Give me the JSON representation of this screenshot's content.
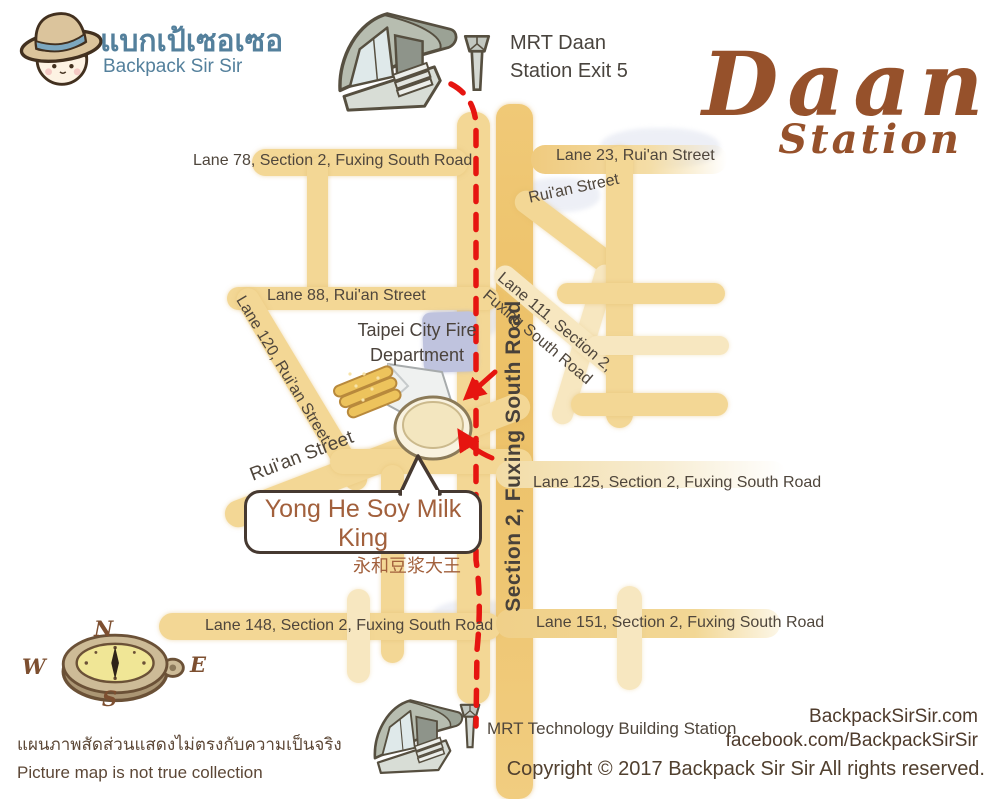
{
  "brand": {
    "name_thai": "แบกเป้เซอเซอ",
    "name_en": "Backpack Sir Sir"
  },
  "title": {
    "main": "Daan",
    "sub": "Station"
  },
  "stations": {
    "daan_line1": "MRT Daan",
    "daan_line2": "Station Exit 5",
    "technology": "MRT Technology Building Station"
  },
  "destination": {
    "name_en": "Yong He Soy Milk King",
    "name_zh": "永和豆浆大王"
  },
  "landmarks": {
    "fire_line1": "Taipei City Fire",
    "fire_line2": "Department"
  },
  "streets": {
    "lane78": "Lane 78, Section 2, Fuxing South Road",
    "lane23": "Lane 23, Rui'an Street",
    "ruian_upper": "Rui'an Street",
    "lane88": "Lane 88, Rui'an Street",
    "lane120": "Lane 120, Rui'an Street",
    "lane111_line1": "Lane 111, Section 2,",
    "lane111_line2": "Fuxing South Road",
    "fuxing_main": "Section 2, Fuxing South Road",
    "ruian_lower": "Rui'an Street",
    "lane125": "Lane 125, Section 2, Fuxing South Road",
    "lane148": "Lane 148, Section 2, Fuxing South Road",
    "lane151": "Lane 151, Section 2, Fuxing South Road"
  },
  "compass": {
    "north": "N",
    "south": "S",
    "east": "E",
    "west": "W"
  },
  "footer": {
    "disclaimer_thai": "แผนภาพสัดส่วนแสดงไม่ตรงกับความเป็นจริง",
    "disclaimer_en": "Picture map is not true collection",
    "website": "BackpackSirSir.com",
    "facebook": "facebook.com/BackpackSirSir",
    "copyright": "Copyright © 2017 Backpack Sir Sir All rights reserved."
  },
  "colors": {
    "route_red": "#e61510",
    "road_main": "#eec46e",
    "road_secondary": "#f3d795",
    "road_light": "#f7e7c0",
    "fire_block": "#bfc3de",
    "brand_blue": "#54809c",
    "title_brown": "#96512b",
    "restaurant_brown": "#a2603c",
    "label_dark": "#4f463c"
  }
}
